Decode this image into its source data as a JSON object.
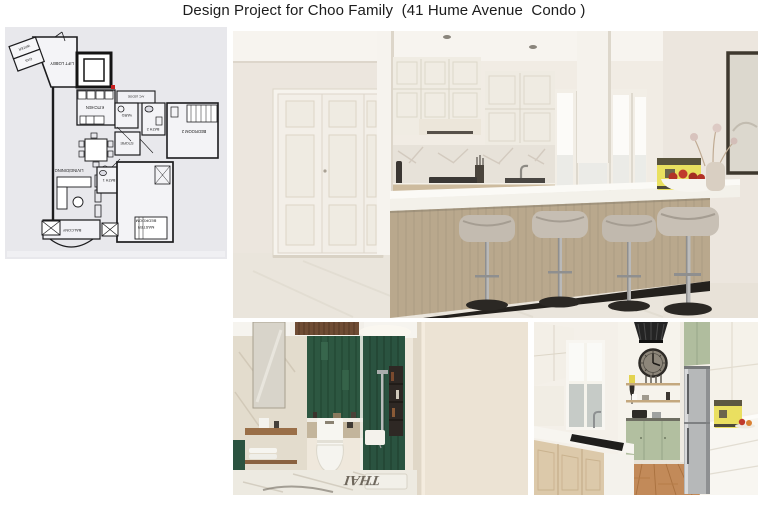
{
  "title": "Design Project for Choo Family  (41 Hume Avenue  Condo )",
  "floor_plan": {
    "orientation_note": "plan shown rotated 180° (labels upside-down)",
    "labels": {
      "water": "WATER",
      "gas": "GAS",
      "lift_lobby": "LIFT LOBBY",
      "ac_ledge": "A/C LEDGE",
      "kitchen": "KITCHEN",
      "yard": "YARD",
      "store": "STORE",
      "bath2": "BATH 2",
      "bedroom2": "BEDROOM 2",
      "living_dining": "LIVING/DINING",
      "bath1": "BATH 1",
      "master_line1": "MASTER",
      "master_line2": "BEDROOM",
      "balcony": "BALCONY"
    }
  },
  "bathroom_photo": {
    "floor_text": "THAI"
  },
  "palette": {
    "wall_cream": "#efe9e1",
    "island_wood": "#b3a28c",
    "stool_fabric": "#c1b9ae",
    "tile_green": "#2d5741",
    "cabinet_sage": "#b2bfa0",
    "coffee_machine_yellow": "#e9e05f",
    "apple_red": "#b23226",
    "plan_background": "#e8e8ec",
    "plan_marker_red": "#c81e1e"
  }
}
